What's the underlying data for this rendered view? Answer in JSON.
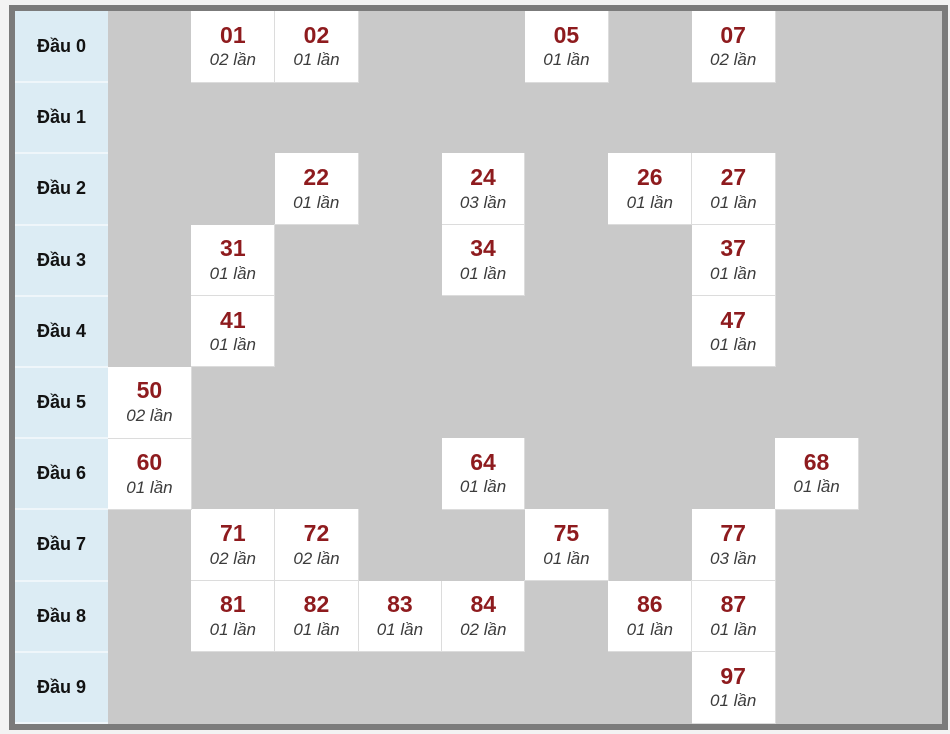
{
  "colors": {
    "frame": "#7b7b7b",
    "empty_bg": "#c9c9c9",
    "label_bg": "#dcecf4",
    "label_color": "#121212",
    "cell_bg": "#ffffff",
    "number_color": "#8e1b1e",
    "count_color": "#3c3c3c"
  },
  "table": {
    "columns": 10,
    "rows": [
      {
        "label": "Đầu 0",
        "cells": [
          {
            "col": 1,
            "number": "01",
            "count": "02 lần"
          },
          {
            "col": 2,
            "number": "02",
            "count": "01 lần"
          },
          {
            "col": 5,
            "number": "05",
            "count": "01 lần"
          },
          {
            "col": 7,
            "number": "07",
            "count": "02 lần"
          }
        ]
      },
      {
        "label": "Đầu 1",
        "cells": []
      },
      {
        "label": "Đầu 2",
        "cells": [
          {
            "col": 2,
            "number": "22",
            "count": "01 lần"
          },
          {
            "col": 4,
            "number": "24",
            "count": "03 lần"
          },
          {
            "col": 6,
            "number": "26",
            "count": "01 lần"
          },
          {
            "col": 7,
            "number": "27",
            "count": "01 lần"
          }
        ]
      },
      {
        "label": "Đầu 3",
        "cells": [
          {
            "col": 1,
            "number": "31",
            "count": "01 lần"
          },
          {
            "col": 4,
            "number": "34",
            "count": "01 lần"
          },
          {
            "col": 7,
            "number": "37",
            "count": "01 lần"
          }
        ]
      },
      {
        "label": "Đầu 4",
        "cells": [
          {
            "col": 1,
            "number": "41",
            "count": "01 lần"
          },
          {
            "col": 7,
            "number": "47",
            "count": "01 lần"
          }
        ]
      },
      {
        "label": "Đầu 5",
        "cells": [
          {
            "col": 0,
            "number": "50",
            "count": "02 lần"
          }
        ]
      },
      {
        "label": "Đầu 6",
        "cells": [
          {
            "col": 0,
            "number": "60",
            "count": "01 lần"
          },
          {
            "col": 4,
            "number": "64",
            "count": "01 lần"
          },
          {
            "col": 8,
            "number": "68",
            "count": "01 lần"
          }
        ]
      },
      {
        "label": "Đầu 7",
        "cells": [
          {
            "col": 1,
            "number": "71",
            "count": "02 lần"
          },
          {
            "col": 2,
            "number": "72",
            "count": "02 lần"
          },
          {
            "col": 5,
            "number": "75",
            "count": "01 lần"
          },
          {
            "col": 7,
            "number": "77",
            "count": "03 lần"
          }
        ]
      },
      {
        "label": "Đầu 8",
        "cells": [
          {
            "col": 1,
            "number": "81",
            "count": "01 lần"
          },
          {
            "col": 2,
            "number": "82",
            "count": "01 lần"
          },
          {
            "col": 3,
            "number": "83",
            "count": "01 lần"
          },
          {
            "col": 4,
            "number": "84",
            "count": "02 lần"
          },
          {
            "col": 6,
            "number": "86",
            "count": "01 lần"
          },
          {
            "col": 7,
            "number": "87",
            "count": "01 lần"
          }
        ]
      },
      {
        "label": "Đầu 9",
        "cells": [
          {
            "col": 7,
            "number": "97",
            "count": "01 lần"
          }
        ]
      }
    ]
  },
  "chart_data": {
    "type": "table",
    "title": "Lottery number frequency by leading digit (Đầu 0–9)",
    "row_labels": [
      "Đầu 0",
      "Đầu 1",
      "Đầu 2",
      "Đầu 3",
      "Đầu 4",
      "Đầu 5",
      "Đầu 6",
      "Đầu 7",
      "Đầu 8",
      "Đầu 9"
    ],
    "unit_label": "lần",
    "entries": [
      {
        "number": "01",
        "times": 2
      },
      {
        "number": "02",
        "times": 1
      },
      {
        "number": "05",
        "times": 1
      },
      {
        "number": "07",
        "times": 2
      },
      {
        "number": "22",
        "times": 1
      },
      {
        "number": "24",
        "times": 3
      },
      {
        "number": "26",
        "times": 1
      },
      {
        "number": "27",
        "times": 1
      },
      {
        "number": "31",
        "times": 1
      },
      {
        "number": "34",
        "times": 1
      },
      {
        "number": "37",
        "times": 1
      },
      {
        "number": "41",
        "times": 1
      },
      {
        "number": "47",
        "times": 1
      },
      {
        "number": "50",
        "times": 2
      },
      {
        "number": "60",
        "times": 1
      },
      {
        "number": "64",
        "times": 1
      },
      {
        "number": "68",
        "times": 1
      },
      {
        "number": "71",
        "times": 2
      },
      {
        "number": "72",
        "times": 2
      },
      {
        "number": "75",
        "times": 1
      },
      {
        "number": "77",
        "times": 3
      },
      {
        "number": "81",
        "times": 1
      },
      {
        "number": "82",
        "times": 1
      },
      {
        "number": "83",
        "times": 1
      },
      {
        "number": "84",
        "times": 2
      },
      {
        "number": "86",
        "times": 1
      },
      {
        "number": "87",
        "times": 1
      },
      {
        "number": "97",
        "times": 1
      }
    ]
  }
}
